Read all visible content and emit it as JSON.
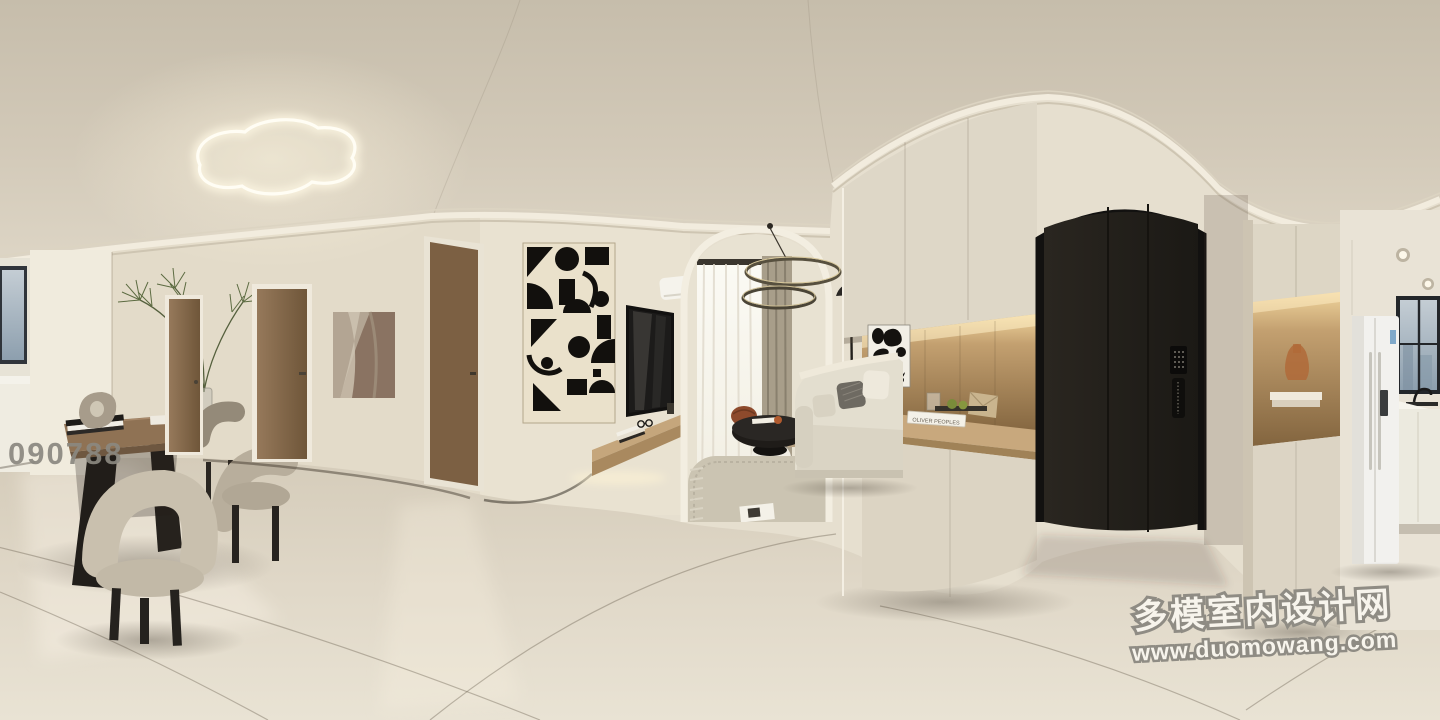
{
  "scene": {
    "description": "360-degree equirectangular panorama render of a cream minimalist apartment interior",
    "areas": [
      "dining area",
      "hallway",
      "living room",
      "entryway",
      "kitchen"
    ]
  },
  "watermarks": {
    "id_code": "090788",
    "site_name": "多模室内设计网",
    "site_url": "www.duomowang.com"
  },
  "decor": {
    "console_book_title": "OLIVER PEOPLES"
  },
  "palette": {
    "ceiling": "#cfc6b5",
    "wall": "#e8e1d1",
    "floor": "#ddd5c4",
    "wood_door": "#8a6c4f",
    "entry_door": "#24211d",
    "niche_wood_lit": "#d9b684",
    "counter_wood": "#c8a87d",
    "sofa": "#e3decf",
    "accent_black": "#1f1c19",
    "window_sky": "#a7b5c0",
    "watermark_gray": "#8f8c84",
    "watermark_white": "#f7f4ec"
  }
}
